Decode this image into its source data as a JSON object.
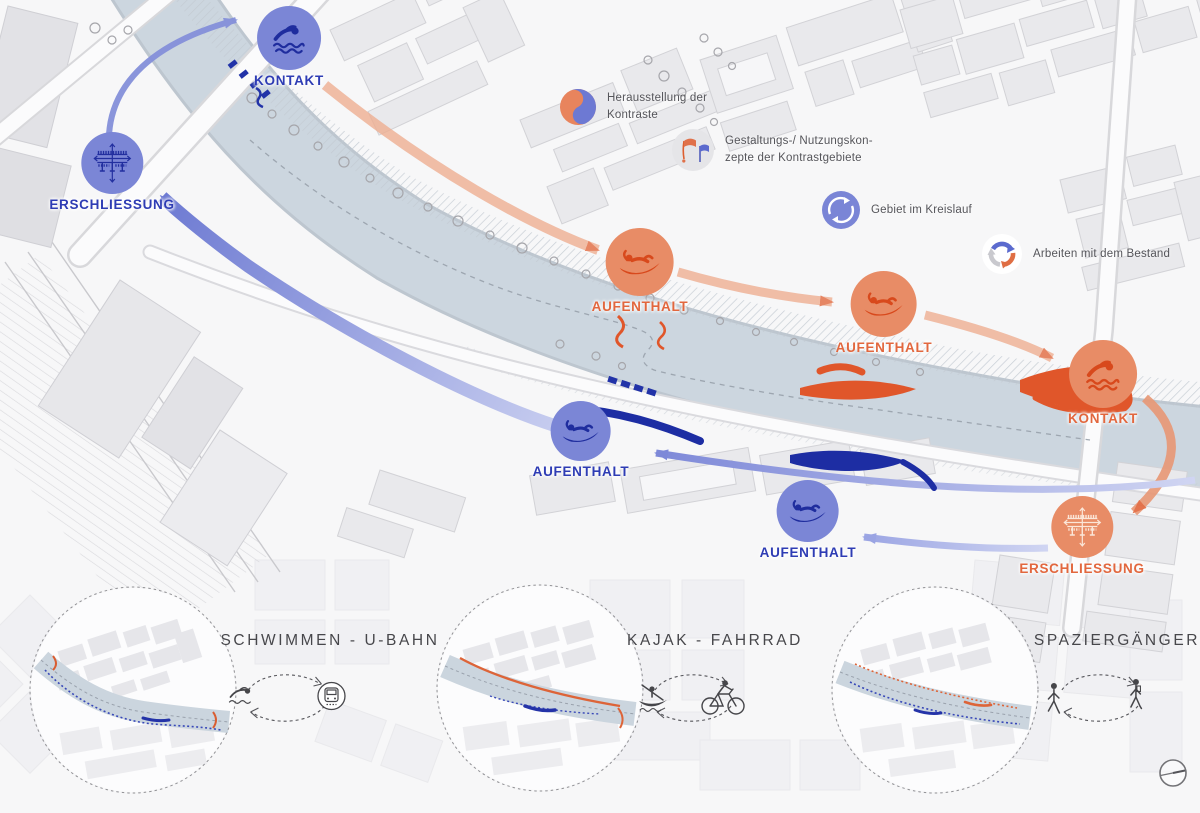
{
  "title_hint": "urban design concept diagram along a river",
  "colors": {
    "blue": "#7b86d6",
    "blue_dark": "#1f2d9e",
    "blue_label": "#2e3cb4",
    "orange": "#e88c66",
    "orange_dark": "#d8491c",
    "orange_label": "#e2673e",
    "river": "#ccd6df",
    "building": "#e9e9ec"
  },
  "nodes": [
    {
      "id": "kontakt-blue",
      "icon": "swimmer-icon",
      "label": "KONTAKT"
    },
    {
      "id": "erschliessung-blue",
      "icon": "bridge-icon",
      "label": "ERSCHLIESSUNG"
    },
    {
      "id": "aufenthalt-orange-1",
      "icon": "lounger-icon",
      "label": "AUFENTHALT"
    },
    {
      "id": "aufenthalt-orange-2",
      "icon": "lounger-icon",
      "label": "AUFENTHALT"
    },
    {
      "id": "kontakt-orange",
      "icon": "swimmer-icon",
      "label": "KONTAKT"
    },
    {
      "id": "erschliessung-orange",
      "icon": "bridge-icon",
      "label": "ERSCHLIESSUNG"
    },
    {
      "id": "aufenthalt-blue-1",
      "icon": "lounger-icon",
      "label": "AUFENTHALT"
    },
    {
      "id": "aufenthalt-blue-2",
      "icon": "lounger-icon",
      "label": "AUFENTHALT"
    }
  ],
  "legend": {
    "items": [
      {
        "icon": "contrast-circle-icon",
        "lines": [
          "Herausstellung der",
          "Kontraste"
        ]
      },
      {
        "icon": "flags-icon",
        "lines": [
          "Gestaltungs-/ Nutzungskon-",
          "zepte der Kontrastgebiete"
        ]
      },
      {
        "icon": "cycle-circle-icon",
        "lines": [
          "Gebiet im Kreislauf",
          ""
        ]
      },
      {
        "icon": "recycle-icon",
        "lines": [
          "Arbeiten mit dem Bestand",
          ""
        ]
      }
    ]
  },
  "bottom": {
    "pairs": [
      {
        "label": "SCHWIMMEN - U-BAHN",
        "icons": [
          "swimmer-icon",
          "ubahn-icon"
        ]
      },
      {
        "label": "KAJAK - FAHRRAD",
        "icons": [
          "kayak-icon",
          "bicycle-icon"
        ]
      },
      {
        "label": "SPAZIERGÄNGER",
        "icons": [
          "walker-icon",
          "walker-icon"
        ]
      }
    ]
  }
}
